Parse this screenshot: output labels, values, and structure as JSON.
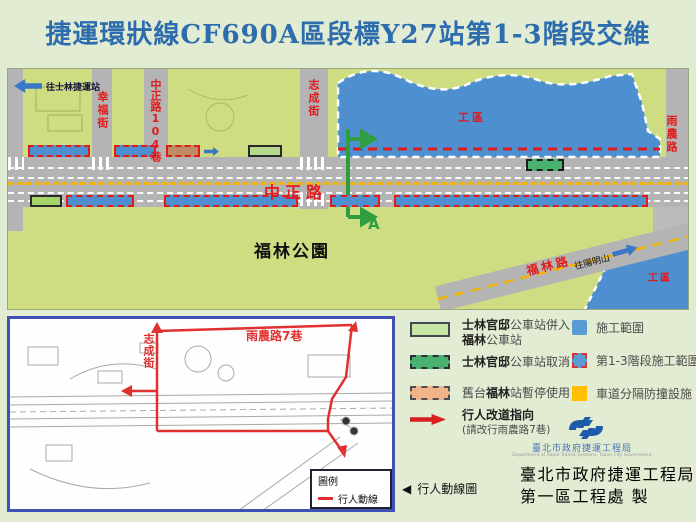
{
  "title": "捷運環狀線CF690A區段標Y27站第1-3階段交維",
  "map": {
    "to_shilin_station": "往士林捷運站",
    "streets": {
      "xingfu_street": "幸福街",
      "zhongzheng_lane104": "中正路104巷",
      "zhicheng_street": "志成街",
      "zhongzheng_road": "中正路",
      "yunong_road": "雨農路",
      "fulin_road": "福林路",
      "to_yangmingshan": "往陽明山"
    },
    "labels": {
      "work_zone_main": "工區",
      "work_zone_corner": "工區",
      "fulin_park": "福林公園",
      "section_marker": "A"
    }
  },
  "inset": {
    "zhicheng_street": "志成街",
    "yunong_lane7": "雨農路7巷",
    "legend_title": "圖例",
    "legend_item": "行人動線",
    "caption_triangle": "◀",
    "caption": "行人動線圖"
  },
  "legend": {
    "left": [
      {
        "line1_bold": "士林官邸",
        "line1_rest": "公車站併入",
        "line2_bold": "福林",
        "line2_rest": "公車站"
      },
      {
        "bold": "士林官邸",
        "rest": "公車站取消"
      },
      {
        "pre": "舊台",
        "bold": "福林",
        "rest": "站暫停使用"
      },
      {
        "label": "行人改道指向",
        "sublabel": "(請改行雨農路7巷)"
      }
    ],
    "right": [
      {
        "label": "施工範圍"
      },
      {
        "label": "第1-3階段施工範圍"
      },
      {
        "label": "車道分隔防撞設施"
      }
    ]
  },
  "footer": {
    "logo_script": "臺北市政府捷運工程局",
    "logo_english": "Department of Rapid Transit Systems, Taipei City Government",
    "org_line1": "臺北市政府捷運工程局",
    "org_line2": "第一區工程處 製"
  },
  "colors": {
    "title_blue": "#2d6dae",
    "construction_blue": "#4e8fd0",
    "phase_border_red": "#e01b1b",
    "park_green": "#cedc82",
    "road_gray": "#b4b4b4",
    "barrier_yellow": "#ffc000",
    "merged_stop_green": "#b8d98d",
    "cancelled_stop_green": "#49b271",
    "suspended_stop_orange": "#f0b488",
    "route_red": "#e03030",
    "section_green": "#2f9e41"
  }
}
